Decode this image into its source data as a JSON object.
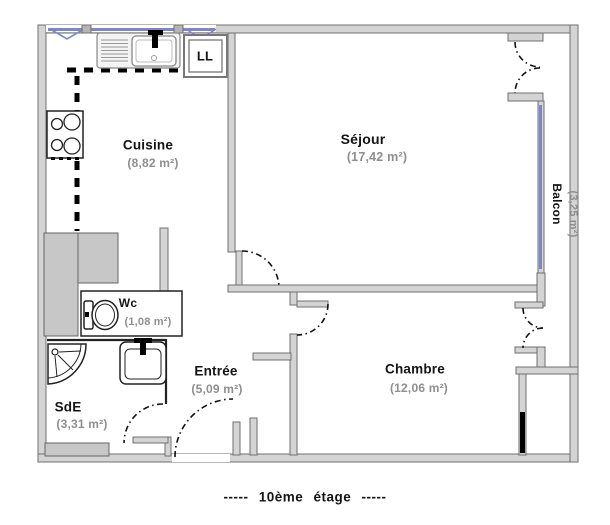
{
  "plan": {
    "rooms": {
      "cuisine": {
        "name": "Cuisine",
        "area": "(8,82 m²)"
      },
      "sejour": {
        "name": "Séjour",
        "area": "(17,42 m²)"
      },
      "wc": {
        "name": "Wc",
        "area": "(1,08 m²)"
      },
      "entree": {
        "name": "Entrée",
        "area": "(5,09 m²)"
      },
      "sde": {
        "name": "SdE",
        "area": "(3,31 m²)"
      },
      "chambre": {
        "name": "Chambre",
        "area": "(12,06 m²)"
      },
      "balcon": {
        "name": "Balcon",
        "area": "(3,25 m²)"
      }
    },
    "appliances": {
      "washing_machine": "LL"
    },
    "footer": "-----  10ème étage  -----",
    "colors": {
      "window_glazing": "#7b87c9",
      "wall_fill": "#d4d4d4",
      "wall_stroke": "#6f6f6f",
      "shaft_fill": "#c7c7c7",
      "area_label": "#8f8f8f",
      "ink": "#141414"
    }
  }
}
